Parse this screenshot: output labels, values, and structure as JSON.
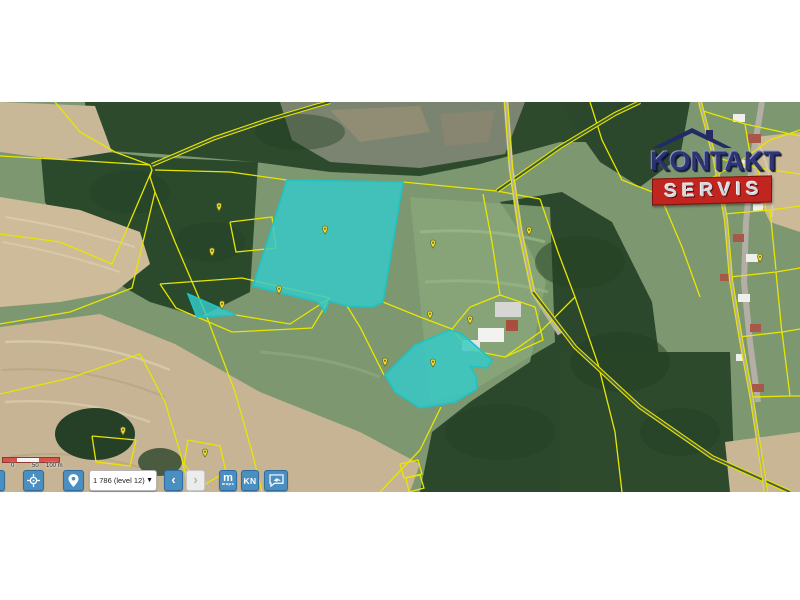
{
  "watermark": {
    "line1": "KONTAKT",
    "line2": "SERVIS",
    "navy": "#2b3272",
    "red": "#c0251f"
  },
  "scalebar": {
    "labels": [
      "0",
      "50",
      "100 m"
    ]
  },
  "toolbar": {
    "dropdown_value": "1 786 (level 12)",
    "dropdown_caret": "▼",
    "back_label": "‹",
    "forward_label": "›",
    "m_label": "m",
    "m_sublabel": "maps",
    "kn_label": "KN",
    "button_color": "#4a8fc0"
  },
  "map": {
    "line_color": "#e8e600",
    "highlight_fill": "rgba(52,203,201,0.82)",
    "highlight_stroke": "#20c3c3",
    "marker_fill": "#f2e32b",
    "marker_stroke": "#6b6b2a",
    "highlighted_parcels": [
      {
        "id": "parcel-large",
        "points": "287,78 403,80 383,200 373,205 347,204 329,199 325,210 318,200 253,184"
      },
      {
        "id": "parcel-triangle",
        "points": "188,192 236,213 197,215"
      },
      {
        "id": "parcel-south",
        "points": "385,273 415,243 450,228 462,232 492,258 487,266 470,264 476,274 477,287 455,300 420,306 395,290"
      }
    ],
    "parcel_lines": [
      "0,54 70,58 150,63",
      "150,63 152,68 150,75 155,90",
      "155,90 175,140 205,210 235,290 252,350 262,390",
      "155,68 230,70 287,78",
      "403,80 455,85 497,89 540,97",
      "540,97 558,150 575,195 598,262 615,330 622,390",
      "55,0 80,30 115,50 150,63",
      "0,132 60,140 112,162 152,68",
      "0,222 70,210 132,186 155,90",
      "160,182 242,176 330,196 312,226 232,230 176,206 160,182",
      "236,213 290,222 330,196",
      "347,204 360,225 384,273",
      "383,200 420,215 452,227",
      "452,227 470,205 500,193 535,205 543,238 505,255 470,248 452,227",
      "500,193 492,140 483,92",
      "590,0 602,38 622,78 660,93 700,83 742,58 770,38 800,28",
      "660,93 682,145 700,195",
      "575,195 540,230 505,255",
      "700,8 745,22 800,34",
      "713,55 758,66 800,72",
      "724,112 770,108 800,104",
      "730,175 776,170 800,166",
      "739,235 782,230 800,227",
      "750,295 790,294 800,294",
      "745,22 752,64",
      "758,66 766,108",
      "770,108 776,168",
      "776,170 782,232",
      "782,230 790,294",
      "0,292 70,276 140,252",
      "140,252 165,300 180,350 190,390",
      "92,334 136,338 130,364 96,360 92,334",
      "188,338 220,344 226,370 202,384 184,362 188,338",
      "400,362 418,358 422,372 404,376 400,362",
      "406,376 420,373 424,386 409,390 406,376",
      "380,390 420,348 441,305",
      "230,120 272,115 276,146 236,150 230,120"
    ],
    "double_paths": [
      {
        "points": "152,63 215,36 268,18 315,4 330,0",
        "inner": "#3d5a3b"
      },
      {
        "points": "497,89 560,45 615,12 640,0",
        "inner": "#3d5a3b"
      },
      {
        "points": "533,190 575,245 640,305 712,355 790,390",
        "inner": "#4a5f46"
      },
      {
        "points": "533,190 520,128 511,66 506,0",
        "inner": "#b3afa6"
      },
      {
        "points": "700,0 715,58 726,118 731,178 741,238 752,298 766,390",
        "inner": "#b3afa6"
      }
    ],
    "markers": [
      [
        219,
        109
      ],
      [
        212,
        154
      ],
      [
        325,
        132
      ],
      [
        433,
        146
      ],
      [
        529,
        133
      ],
      [
        279,
        192
      ],
      [
        222,
        207
      ],
      [
        430,
        217
      ],
      [
        470,
        222
      ],
      [
        433,
        265
      ],
      [
        385,
        264
      ],
      [
        123,
        333
      ],
      [
        205,
        355
      ],
      [
        760,
        160
      ]
    ]
  }
}
